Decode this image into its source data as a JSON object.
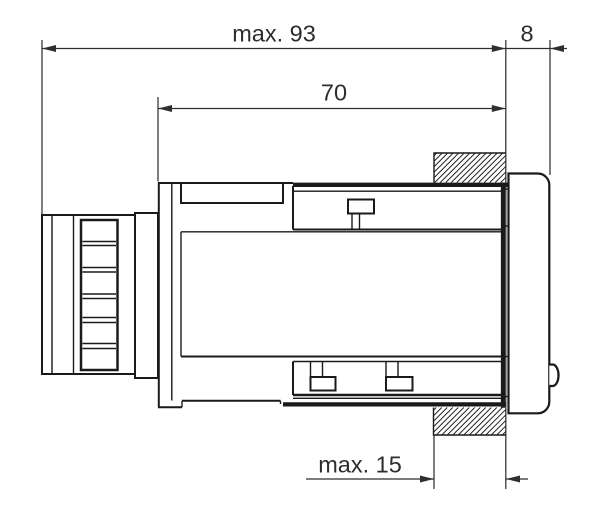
{
  "drawing": {
    "type": "technical-dimension-drawing",
    "background_color": "#ffffff",
    "line_color": "#1a1a1a",
    "dimension_color": "#2f2f2f",
    "dimensions": {
      "overall_length": {
        "label": "max. 93"
      },
      "bezel_depth": {
        "label": "8"
      },
      "case_length": {
        "label": "70"
      },
      "panel_thickness": {
        "label": "max. 15"
      }
    }
  }
}
